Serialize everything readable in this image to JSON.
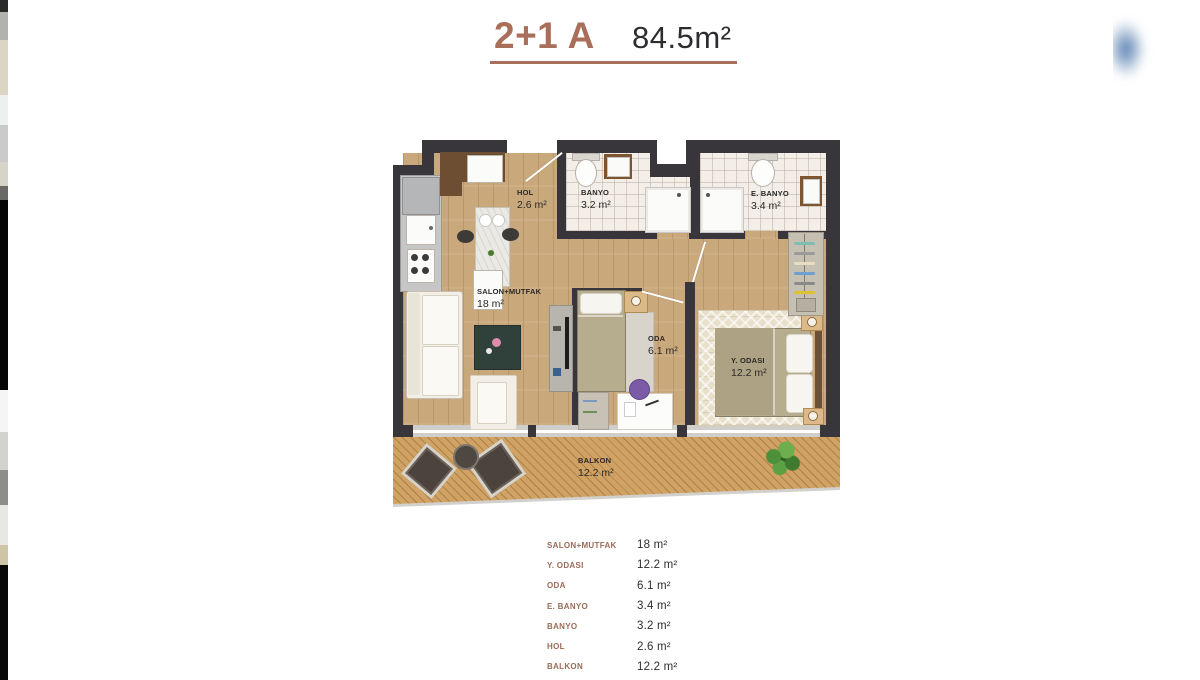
{
  "header": {
    "unit_type": "2+1 A",
    "total_area": "84.5m²"
  },
  "floor_plan": {
    "rooms": [
      {
        "name": "HOL",
        "area": "2.6 m²"
      },
      {
        "name": "BANYO",
        "area": "3.2 m²"
      },
      {
        "name": "E. BANYO",
        "area": "3.4 m²"
      },
      {
        "name": "SALON+MUTFAK",
        "area": "18 m²"
      },
      {
        "name": "ODA",
        "area": "6.1 m²"
      },
      {
        "name": "Y. ODASI",
        "area": "12.2 m²"
      },
      {
        "name": "BALKON",
        "area": "12.2 m²"
      }
    ]
  },
  "legend": {
    "rows": [
      {
        "label": "SALON+MUTFAK",
        "value": "18 m²"
      },
      {
        "label": "Y. ODASI",
        "value": "12.2 m²"
      },
      {
        "label": "ODA",
        "value": "6.1 m²"
      },
      {
        "label": "E. BANYO",
        "value": "3.4 m²"
      },
      {
        "label": "BANYO",
        "value": "3.2 m²"
      },
      {
        "label": "HOL",
        "value": "2.6 m²"
      },
      {
        "label": "BALKON",
        "value": "12.2 m²"
      }
    ]
  },
  "colors": {
    "accent": "#a96f5b",
    "text_dark": "#2d2c31",
    "legend_label": "#9c6b57",
    "wall": "#39363b",
    "wood_floor": "#c9a87c",
    "balcony_wood": "#d0a263",
    "tile": "#f3efe8"
  }
}
